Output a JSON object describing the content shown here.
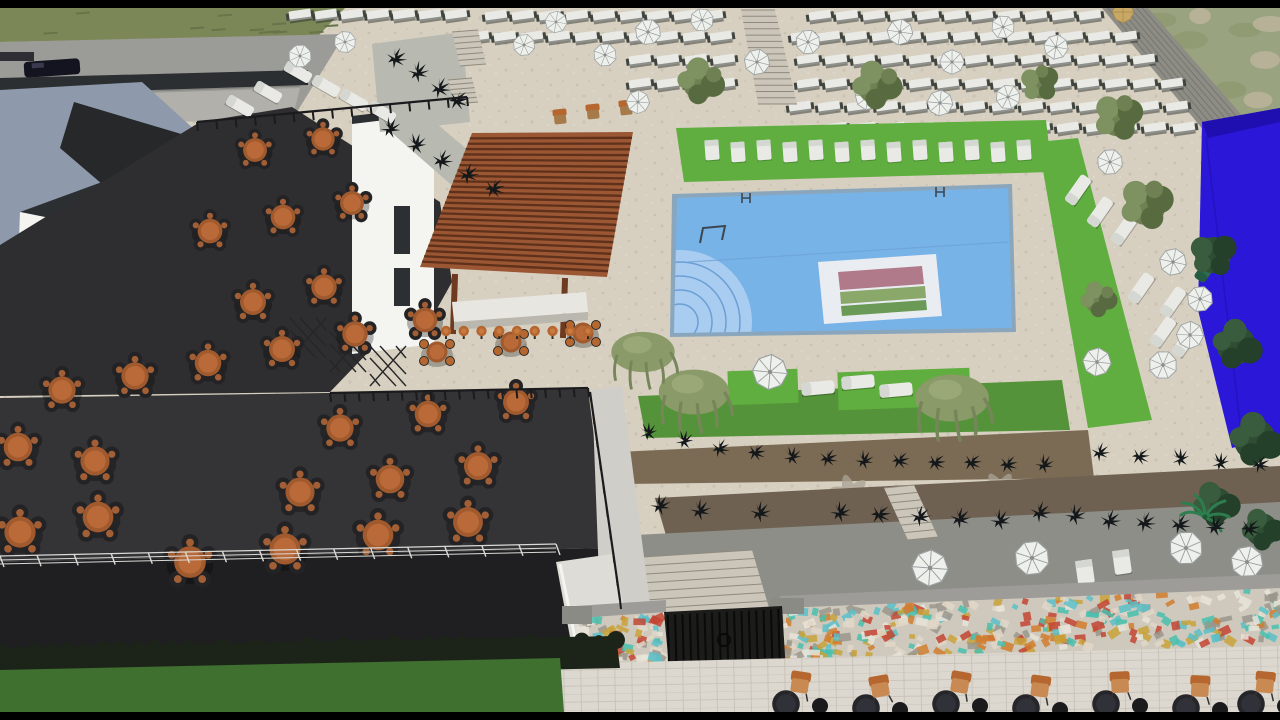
{
  "colors": {
    "letterbox": "#000000",
    "paving": "#d7d0c1",
    "paving_speck": "#c3bbaa",
    "paving_light": "#dcd8cf",
    "walk_line": "#b9b4a8",
    "street": "#9b9b97",
    "street_light": "#b2b0ab",
    "curb": "#7f7f7b",
    "car_body": "#141420",
    "grass_top": "#7b8757",
    "grass_streak": "#67744a",
    "grass_bottom": "#3f7030",
    "hedge_dark": "#1c241a",
    "lawn": "#5fae3f",
    "hedge_bright": "#55933a",
    "scrub": "#9aa37f",
    "scrub_light": "#b9b29a",
    "scrub_dark": "#8f9a72",
    "slate": "#8e9aab",
    "slate_shade": "#7d8a9c",
    "white_wall": "#f4f4f1",
    "white_wall_side": "#e7e7e3",
    "dark_roof": "#2c2f31",
    "roof_wedge": "#26282a",
    "terrace": "#2e2e30",
    "terrace_lower": "#343436",
    "fascia": "#1f1f21",
    "light_wall": "#cfcec8",
    "angled_wall": "#dddcd6",
    "table_orange": "#b96a38",
    "table_orange_dark": "#a05a2e",
    "chair_dark": "#232325",
    "pergola_base": "#9b5633",
    "pergola_slat": "#5f311b",
    "pergola_post": "#6e3a20",
    "bar_counter": "#e8e6e0",
    "bar_counter_shade": "#b9b7ae",
    "stool_orange": "#b5672f",
    "pool_coping": "#8aa6bc",
    "pool_water": "#78b3e8",
    "pool_light": "#a9ccf1",
    "pool_line": "#6b9fd4",
    "pool_metal": "#3c4650",
    "logo_panel": "#e9edf1",
    "logo_mauve": "#b07a8a",
    "logo_green1": "#8aa86a",
    "logo_green2": "#6a9a55",
    "umbrella": "#eef0ec",
    "umbrella_line": "#9aa0a0",
    "umbrella_tan": "#c8a864",
    "lounger": "#e9eae6",
    "lounger_back": "#d5d8d2",
    "teal_lounger": "#2e6b4f",
    "tree_mid": "#6f8152",
    "tree_hi": "#7e9160",
    "tree_lo": "#586b40",
    "dtree_mid": "#2f4d33",
    "dtree_hi": "#3a5c3e",
    "dtree_lo": "#24402a",
    "wtree": "#8a9a68",
    "wtree_line": "#76865a",
    "wtree_hi": "#9aa878",
    "palm": "#2e7d4f",
    "plant_black": "#14181a",
    "mulch": "#7c6b54",
    "mulch_dark": "#6e6152",
    "gray_terrace": "#8e8e89",
    "palm_shadow": "#aaa396",
    "stone_wall": "#8d8c85",
    "stone_line": "#6f6e68",
    "blue_box": "#2a17d8",
    "blue_box_dark": "#1f0fb0",
    "mosaic_base": "#cfc9bd",
    "wall_cap": "#9d9c98",
    "pier": "#8b8b86",
    "gate_bg": "#1c1c1a",
    "gate_bar": "#0a0a0a",
    "railing_dark": "#1b1b1d",
    "railing_light": "#d9d9d6",
    "stairs_face": "#cbc6b9",
    "stairs_line": "#8f8a7e"
  },
  "scene": {
    "white_rows": [
      {
        "y": 15,
        "x0": 300,
        "x1": 470,
        "step": 26,
        "skip": []
      },
      {
        "y": 16,
        "x0": 496,
        "x1": 1104,
        "step": 27,
        "skip": [
          [
            730,
            796
          ]
        ]
      },
      {
        "y": 37,
        "x0": 478,
        "x1": 1150,
        "step": 27,
        "skip": [
          [
            728,
            796
          ]
        ]
      },
      {
        "y": 60,
        "x0": 640,
        "x1": 1160,
        "step": 28,
        "skip": [
          [
            726,
            792
          ]
        ]
      },
      {
        "y": 84,
        "x0": 640,
        "x1": 1172,
        "step": 28,
        "skip": [
          [
            724,
            790
          ]
        ]
      },
      {
        "y": 107,
        "x0": 800,
        "x1": 1182,
        "step": 29,
        "skip": []
      },
      {
        "y": 128,
        "x0": 836,
        "x1": 1188,
        "step": 29,
        "skip": []
      }
    ],
    "tables_upper": [
      [
        255,
        150,
        0.92
      ],
      [
        323,
        139,
        0.9
      ],
      [
        210,
        231,
        0.95
      ],
      [
        283,
        217,
        0.95
      ],
      [
        352,
        203,
        0.92
      ],
      [
        253,
        302,
        1.0
      ],
      [
        324,
        287,
        0.98
      ],
      [
        62,
        390,
        1.05
      ],
      [
        135,
        376,
        1.05
      ],
      [
        208,
        363,
        1.02
      ],
      [
        282,
        349,
        1.0
      ],
      [
        355,
        334,
        0.98
      ],
      [
        425,
        320,
        0.95
      ]
    ],
    "tables_lower": [
      [
        340,
        428,
        1.05
      ],
      [
        428,
        414,
        1.02
      ],
      [
        516,
        402,
        1.0
      ],
      [
        300,
        492,
        1.12
      ],
      [
        390,
        479,
        1.1
      ],
      [
        478,
        466,
        1.08
      ],
      [
        190,
        562,
        1.22
      ],
      [
        285,
        549,
        1.2
      ],
      [
        378,
        535,
        1.18
      ],
      [
        468,
        522,
        1.15
      ],
      [
        18,
        447,
        1.1
      ],
      [
        95,
        461,
        1.12
      ],
      [
        20,
        532,
        1.2
      ],
      [
        98,
        517,
        1.18
      ]
    ],
    "hightops": [
      [
        437,
        352
      ],
      [
        511,
        342
      ],
      [
        583,
        333
      ]
    ],
    "barstools": {
      "x0": 446,
      "x1": 588,
      "y": 331,
      "n": 9
    },
    "brown_chairs": [
      [
        560,
        117
      ],
      [
        593,
        112
      ],
      [
        626,
        108
      ]
    ],
    "umbrellas": [
      [
        648,
        32,
        1
      ],
      [
        702,
        20,
        0.9
      ],
      [
        757,
        62,
        1
      ],
      [
        808,
        42,
        0.95
      ],
      [
        900,
        32,
        1
      ],
      [
        952,
        62,
        0.95
      ],
      [
        1003,
        27,
        0.9
      ],
      [
        1056,
        47,
        0.95
      ],
      [
        868,
        97,
        1
      ],
      [
        940,
        103,
        1
      ],
      [
        1008,
        97,
        0.95
      ],
      [
        638,
        102,
        0.9
      ],
      [
        556,
        22,
        0.85
      ],
      [
        605,
        55,
        0.9
      ],
      [
        524,
        45,
        0.85
      ],
      [
        300,
        56,
        0.9
      ],
      [
        345,
        42,
        0.85
      ],
      [
        1110,
        162,
        1
      ],
      [
        1173,
        262,
        1.05
      ],
      [
        1200,
        299,
        1
      ],
      [
        1190,
        335,
        1.05
      ],
      [
        1097,
        362,
        1.1
      ],
      [
        1163,
        365,
        1.1
      ],
      [
        770,
        372,
        1.35
      ],
      [
        930,
        568,
        1.4
      ],
      [
        1032,
        558,
        1.35
      ],
      [
        1186,
        548,
        1.3
      ],
      [
        1247,
        562,
        1.25
      ]
    ],
    "umbrella_tan": [
      1123,
      12,
      0.9
    ],
    "lawn_cabanas": [
      [
        712,
        150
      ],
      [
        738,
        152
      ],
      [
        764,
        150
      ],
      [
        790,
        152
      ],
      [
        816,
        150
      ],
      [
        842,
        152
      ],
      [
        868,
        150
      ],
      [
        894,
        152
      ],
      [
        920,
        150
      ],
      [
        946,
        152
      ],
      [
        972,
        150
      ],
      [
        998,
        152
      ],
      [
        1024,
        150
      ]
    ],
    "loungers_deck": [
      [
        298,
        72
      ],
      [
        326,
        86
      ],
      [
        354,
        100
      ],
      [
        268,
        92
      ],
      [
        240,
        106
      ],
      [
        382,
        112
      ]
    ],
    "loungers_right": [
      [
        1078,
        190
      ],
      [
        1100,
        212
      ],
      [
        1124,
        230
      ],
      [
        1141,
        288
      ],
      [
        1173,
        302
      ],
      [
        1163,
        332
      ],
      [
        1185,
        342
      ]
    ],
    "teal_lounger": [
      1207,
      268
    ],
    "bed_loungers": [
      [
        818,
        388
      ],
      [
        858,
        382
      ],
      [
        896,
        390
      ]
    ],
    "cabanas_terrace": [
      [
        1085,
        572
      ],
      [
        1122,
        562
      ]
    ],
    "trees": [
      [
        700,
        82,
        1.1
      ],
      [
        876,
        86,
        1.15
      ],
      [
        1040,
        84,
        0.9
      ],
      [
        1118,
        118,
        1.15
      ],
      [
        1146,
        205,
        1.25
      ],
      [
        1098,
        300,
        0.85
      ]
    ],
    "dark_trees": [
      [
        1213,
        255,
        1.2
      ],
      [
        1236,
        345,
        1.3
      ],
      [
        1255,
        440,
        1.4
      ],
      [
        1215,
        505,
        1.2
      ],
      [
        1262,
        530,
        1.1
      ]
    ],
    "weeping_trees": [
      [
        694,
        392,
        1.0
      ],
      [
        952,
        398,
        1.05
      ],
      [
        643,
        352,
        0.9
      ]
    ],
    "palms": [
      [
        1205,
        517,
        1.0
      ]
    ],
    "plants": [
      [
        396,
        58,
        1
      ],
      [
        418,
        72,
        1
      ],
      [
        440,
        88,
        1
      ],
      [
        458,
        100,
        1
      ],
      [
        390,
        128,
        1
      ],
      [
        416,
        144,
        1
      ],
      [
        442,
        160,
        1
      ],
      [
        468,
        174,
        1
      ],
      [
        494,
        188,
        1
      ],
      [
        648,
        432,
        0.9
      ],
      [
        684,
        440,
        0.9
      ],
      [
        720,
        448,
        0.9
      ],
      [
        756,
        452,
        0.9
      ],
      [
        792,
        456,
        0.9
      ],
      [
        828,
        458,
        0.9
      ],
      [
        864,
        460,
        0.9
      ],
      [
        900,
        460,
        0.9
      ],
      [
        936,
        462,
        0.9
      ],
      [
        972,
        462,
        0.9
      ],
      [
        1008,
        464,
        0.9
      ],
      [
        1044,
        464,
        0.9
      ],
      [
        1100,
        452,
        0.9
      ],
      [
        1140,
        456,
        0.9
      ],
      [
        1180,
        458,
        0.9
      ],
      [
        1220,
        462,
        0.9
      ],
      [
        1260,
        464,
        0.9
      ],
      [
        840,
        512,
        1
      ],
      [
        880,
        514,
        1
      ],
      [
        920,
        516,
        1
      ],
      [
        960,
        518,
        1
      ],
      [
        1000,
        520,
        1
      ],
      [
        1040,
        512,
        1
      ],
      [
        1075,
        515,
        1
      ],
      [
        1110,
        520,
        1
      ],
      [
        1145,
        522,
        1
      ],
      [
        1180,
        524,
        1
      ],
      [
        1215,
        526,
        1
      ],
      [
        1250,
        528,
        1
      ],
      [
        660,
        505,
        1
      ],
      [
        700,
        510,
        1
      ],
      [
        760,
        512,
        1
      ]
    ],
    "palm_shadows": [
      [
        850,
        495
      ],
      [
        1000,
        492
      ],
      [
        1180,
        490
      ]
    ],
    "mosaic_segments": [
      {
        "x0": 578,
        "y0": 616,
        "x1": 664,
        "y1": 610,
        "h": 62,
        "n": 70
      },
      {
        "x0": 782,
        "y0": 606,
        "x1": 1280,
        "y1": 584,
        "h": 64,
        "n": 330
      }
    ],
    "mosaic_colors": [
      "#49bfae",
      "#d07c2e",
      "#c9a23a",
      "#c34432",
      "#e8e4da",
      "#9a968c",
      "#5bc0c8",
      "#e0d7c8"
    ],
    "gate": {
      "x0": 664,
      "y0": 612,
      "x1": 782,
      "y1": 606,
      "h": 64,
      "bars": 16
    },
    "railings": [
      {
        "x1": 330,
        "y1": 393,
        "x2": 588,
        "y2": 388,
        "n": 18,
        "light": false
      },
      {
        "x1": 197,
        "y1": 122,
        "x2": 467,
        "y2": 97,
        "n": 14,
        "light": false
      },
      {
        "x1": 590,
        "y1": 392,
        "x2": 620,
        "y2": 600,
        "n": 9,
        "light": false
      },
      {
        "x1": 0,
        "y1": 556,
        "x2": 556,
        "y2": 544,
        "n": 15,
        "light": true
      }
    ],
    "stairs": [
      {
        "tl": [
          741,
          10
        ],
        "tr": [
          775,
          10
        ],
        "bl": [
          758,
          104
        ],
        "br": [
          797,
          104
        ],
        "n": 15
      },
      {
        "tl": [
          628,
          558
        ],
        "tr": [
          752,
          550
        ],
        "bl": [
          643,
          626
        ],
        "br": [
          772,
          618
        ],
        "n": 8
      },
      {
        "tl": [
          884,
          488
        ],
        "tr": [
          914,
          485
        ],
        "bl": [
          908,
          540
        ],
        "br": [
          938,
          537
        ],
        "n": 7
      },
      {
        "tl": [
          452,
          32
        ],
        "tr": [
          478,
          30
        ],
        "bl": [
          460,
          66
        ],
        "br": [
          486,
          64
        ],
        "n": 6
      },
      {
        "tl": [
          448,
          80
        ],
        "tr": [
          472,
          78
        ],
        "bl": [
          454,
          104
        ],
        "br": [
          478,
          102
        ],
        "n": 5
      }
    ],
    "bottom_sets": [
      [
        800,
        690
      ],
      [
        880,
        694
      ],
      [
        960,
        690
      ],
      [
        1040,
        694
      ],
      [
        1120,
        690
      ],
      [
        1200,
        694
      ],
      [
        1265,
        690
      ]
    ],
    "hedge_line": {
      "x1": 0,
      "y1": 652,
      "x2": 616,
      "y2": 640,
      "n": 36
    },
    "scrub_blobs": [
      [
        1160,
        20
      ],
      [
        1200,
        16
      ],
      [
        1245,
        30
      ],
      [
        1265,
        60
      ],
      [
        1230,
        90
      ],
      [
        1258,
        100
      ],
      [
        1190,
        40
      ],
      [
        1270,
        24
      ]
    ],
    "grass_streaks": {
      "x0": 10,
      "x1": 330,
      "y0": 12,
      "y1": 34,
      "n": 14
    },
    "wall_band": {
      "x0": 1102,
      "y0": 8,
      "x1": 1148,
      "y1": 8,
      "bx": 1253,
      "by": 128,
      "cx": 1220,
      "cy": 150,
      "lines": 7
    },
    "pergola": {
      "quad": [
        [
          472,
          133
        ],
        [
          633,
          132
        ],
        [
          607,
          277
        ],
        [
          420,
          267
        ]
      ],
      "slats": 24
    },
    "trellis": [
      [
        308,
        338
      ],
      [
        348,
        352
      ],
      [
        388,
        366
      ]
    ]
  }
}
